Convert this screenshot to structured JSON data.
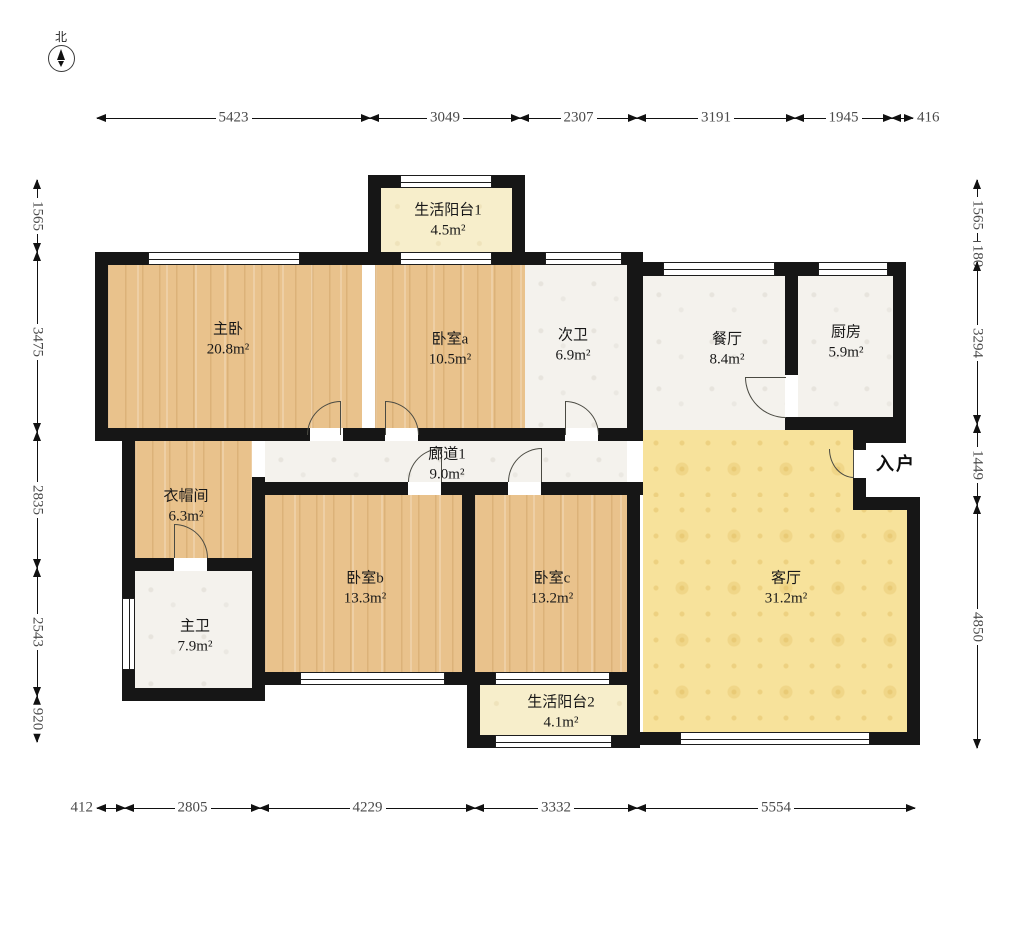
{
  "compass": {
    "label": "北"
  },
  "entrance": {
    "label": "入户"
  },
  "colors": {
    "wall": "#161616",
    "wood_floor": "#e9c28c",
    "tile_floor": "#f4f2ed",
    "balcony_floor": "#f7eecb",
    "living_floor": "#f7e29b",
    "dimension_text": "#4a4a4a"
  },
  "floorplan": {
    "rooms": [
      {
        "id": "master-bedroom",
        "name": "主卧",
        "area": "20.8m²",
        "type": "wood",
        "rects": [
          [
            108,
            265,
            254,
            163
          ]
        ],
        "label_x": 228,
        "label_y": 340
      },
      {
        "id": "bedroom-a",
        "name": "卧室a",
        "area": "10.5m²",
        "type": "wood",
        "rects": [
          [
            375,
            265,
            150,
            163
          ]
        ],
        "label_x": 450,
        "label_y": 350
      },
      {
        "id": "balcony-1",
        "name": "生活阳台1",
        "area": "4.5m²",
        "type": "cream",
        "rects": [
          [
            381,
            188,
            131,
            64
          ]
        ],
        "label_x": 448,
        "label_y": 221
      },
      {
        "id": "second-bath",
        "name": "次卫",
        "area": "6.9m²",
        "type": "marble",
        "rects": [
          [
            525,
            265,
            102,
            163
          ]
        ],
        "label_x": 573,
        "label_y": 346
      },
      {
        "id": "dining",
        "name": "餐厅",
        "area": "8.4m²",
        "type": "marble",
        "rects": [
          [
            643,
            276,
            142,
            154
          ]
        ],
        "label_x": 727,
        "label_y": 350
      },
      {
        "id": "kitchen",
        "name": "厨房",
        "area": "5.9m²",
        "type": "marble",
        "rects": [
          [
            798,
            276,
            95,
            141
          ]
        ],
        "label_x": 846,
        "label_y": 343
      },
      {
        "id": "closet",
        "name": "衣帽间",
        "area": "6.3m²",
        "type": "wood",
        "rects": [
          [
            135,
            441,
            117,
            117
          ]
        ],
        "label_x": 186,
        "label_y": 507
      },
      {
        "id": "corridor",
        "name": "廊道1",
        "area": "9.0m²",
        "type": "marble",
        "rects": [
          [
            265,
            441,
            362,
            41
          ]
        ],
        "label_x": 447,
        "label_y": 465
      },
      {
        "id": "master-bath",
        "name": "主卫",
        "area": "7.9m²",
        "type": "marble",
        "rects": [
          [
            135,
            571,
            117,
            117
          ]
        ],
        "label_x": 195,
        "label_y": 637
      },
      {
        "id": "bedroom-b",
        "name": "卧室b",
        "area": "13.3m²",
        "type": "wood",
        "rects": [
          [
            265,
            495,
            197,
            177
          ]
        ],
        "label_x": 365,
        "label_y": 589
      },
      {
        "id": "bedroom-c",
        "name": "卧室c",
        "area": "13.2m²",
        "type": "wood",
        "rects": [
          [
            475,
            495,
            152,
            177
          ]
        ],
        "label_x": 552,
        "label_y": 589
      },
      {
        "id": "balcony-2",
        "name": "生活阳台2",
        "area": "4.1m²",
        "type": "cream",
        "rects": [
          [
            480,
            685,
            147,
            50
          ]
        ],
        "label_x": 561,
        "label_y": 713
      },
      {
        "id": "living",
        "name": "客厅",
        "area": "31.2m²",
        "type": "yellow",
        "rects": [
          [
            643,
            430,
            210,
            67
          ],
          [
            643,
            497,
            264,
            235
          ]
        ],
        "label_x": 786,
        "label_y": 589
      }
    ],
    "walls": [
      [
        368,
        175,
        157,
        13
      ],
      [
        368,
        175,
        13,
        90
      ],
      [
        512,
        175,
        13,
        90
      ],
      [
        95,
        252,
        280,
        13
      ],
      [
        375,
        252,
        137,
        13
      ],
      [
        512,
        252,
        131,
        13
      ],
      [
        643,
        262,
        263,
        14
      ],
      [
        95,
        252,
        13,
        189
      ],
      [
        122,
        428,
        13,
        273
      ],
      [
        95,
        428,
        215,
        13
      ],
      [
        343,
        428,
        42,
        13
      ],
      [
        418,
        428,
        147,
        13
      ],
      [
        598,
        428,
        45,
        13
      ],
      [
        122,
        558,
        52,
        13
      ],
      [
        207,
        558,
        58,
        13
      ],
      [
        252,
        428,
        13,
        13
      ],
      [
        252,
        477,
        13,
        224
      ],
      [
        122,
        688,
        143,
        13
      ],
      [
        462,
        482,
        13,
        203
      ],
      [
        252,
        482,
        156,
        13
      ],
      [
        441,
        482,
        67,
        13
      ],
      [
        541,
        482,
        102,
        13
      ],
      [
        252,
        672,
        388,
        13
      ],
      [
        467,
        672,
        13,
        76
      ],
      [
        467,
        735,
        173,
        13
      ],
      [
        627,
        252,
        16,
        189
      ],
      [
        627,
        482,
        13,
        266
      ],
      [
        627,
        732,
        293,
        13
      ],
      [
        907,
        497,
        13,
        248
      ],
      [
        853,
        497,
        67,
        13
      ],
      [
        853,
        428,
        13,
        22
      ],
      [
        853,
        478,
        13,
        32
      ],
      [
        785,
        417,
        121,
        13
      ],
      [
        853,
        430,
        53,
        13
      ],
      [
        785,
        276,
        13,
        99
      ],
      [
        893,
        276,
        13,
        154
      ]
    ],
    "windows": [
      [
        148,
        252,
        152,
        13,
        "h"
      ],
      [
        400,
        175,
        92,
        13,
        "h"
      ],
      [
        400,
        252,
        92,
        13,
        "h"
      ],
      [
        545,
        252,
        77,
        13,
        "h"
      ],
      [
        663,
        262,
        112,
        14,
        "h"
      ],
      [
        818,
        262,
        70,
        14,
        "h"
      ],
      [
        122,
        598,
        13,
        72,
        "v"
      ],
      [
        300,
        672,
        145,
        13,
        "h"
      ],
      [
        495,
        672,
        115,
        13,
        "h"
      ],
      [
        495,
        735,
        117,
        13,
        "h"
      ],
      [
        680,
        732,
        190,
        13,
        "h"
      ]
    ],
    "doors": [
      {
        "x": 307,
        "y": 401,
        "w": 34,
        "h": 34,
        "corner": "tl",
        "leaf": "right"
      },
      {
        "x": 385,
        "y": 401,
        "w": 34,
        "h": 34,
        "corner": "tr",
        "leaf": "left"
      },
      {
        "x": 565,
        "y": 401,
        "w": 34,
        "h": 34,
        "corner": "tr",
        "leaf": "left"
      },
      {
        "x": 408,
        "y": 448,
        "w": 34,
        "h": 34,
        "corner": "tl",
        "leaf": "right"
      },
      {
        "x": 508,
        "y": 448,
        "w": 34,
        "h": 34,
        "corner": "tl",
        "leaf": "right"
      },
      {
        "x": 174,
        "y": 524,
        "w": 34,
        "h": 34,
        "corner": "tr",
        "leaf": "left"
      },
      {
        "x": 745,
        "y": 377,
        "w": 41,
        "h": 41,
        "corner": "bl",
        "leaf": "top"
      },
      {
        "x": 829,
        "y": 449,
        "w": 25,
        "h": 29,
        "corner": "bl",
        "leaf": "right"
      }
    ],
    "dimensions": {
      "top": {
        "axis": 118,
        "segments": [
          {
            "a": 97,
            "b": 370,
            "label": "5423"
          },
          {
            "a": 370,
            "b": 520,
            "label": "3049"
          },
          {
            "a": 520,
            "b": 637,
            "label": "2307"
          },
          {
            "a": 637,
            "b": 795,
            "label": "3191"
          },
          {
            "a": 795,
            "b": 892,
            "label": "1945"
          },
          {
            "a": 892,
            "b": 913,
            "label": "416",
            "out": "after"
          }
        ]
      },
      "bottom": {
        "axis": 808,
        "segments": [
          {
            "a": 97,
            "b": 125,
            "label": "412",
            "out": "before"
          },
          {
            "a": 125,
            "b": 260,
            "label": "2805"
          },
          {
            "a": 260,
            "b": 475,
            "label": "4229"
          },
          {
            "a": 475,
            "b": 637,
            "label": "3332"
          },
          {
            "a": 637,
            "b": 915,
            "label": "5554"
          }
        ]
      },
      "left": {
        "axis": 37,
        "segments": [
          {
            "a": 180,
            "b": 252,
            "label": "1565"
          },
          {
            "a": 252,
            "b": 432,
            "label": "3475"
          },
          {
            "a": 432,
            "b": 568,
            "label": "2835"
          },
          {
            "a": 568,
            "b": 696,
            "label": "2543"
          },
          {
            "a": 696,
            "b": 742,
            "label": "920"
          }
        ]
      },
      "right": {
        "axis": 977,
        "segments": [
          {
            "a": 180,
            "b": 250,
            "label": "1565"
          },
          {
            "a": 250,
            "b": 262,
            "label": "180"
          },
          {
            "a": 262,
            "b": 424,
            "label": "3294"
          },
          {
            "a": 424,
            "b": 505,
            "label": "1449"
          },
          {
            "a": 505,
            "b": 748,
            "label": "4850"
          }
        ]
      }
    }
  }
}
